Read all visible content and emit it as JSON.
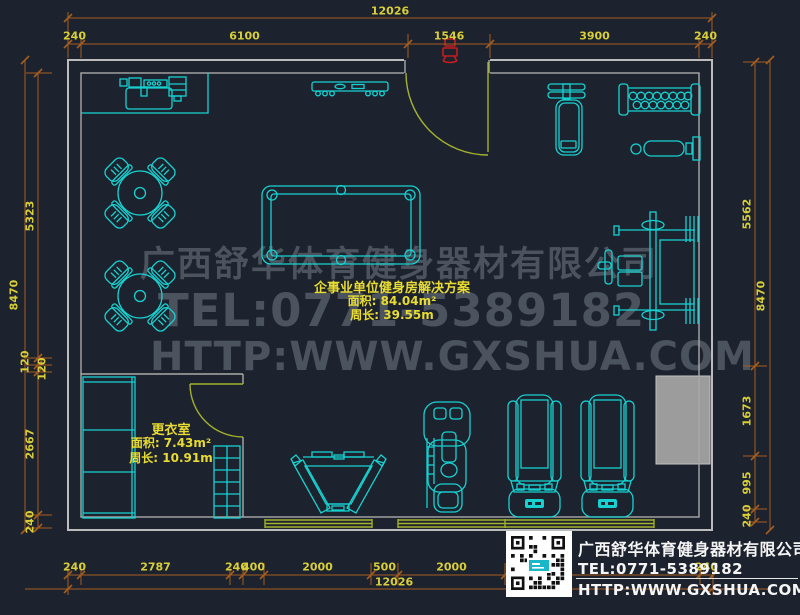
{
  "plan": {
    "room_label": {
      "title": "企事业单位健身房解决方案",
      "area": "面积: 84.04m²",
      "perimeter": "周长: 39.55m"
    },
    "changing_room_label": {
      "title": "更衣室",
      "area": "面积: 7.43m²",
      "perimeter": "周长: 10.91m"
    }
  },
  "watermark": {
    "company": "广西舒华体育健身器材有限公司",
    "tel": "TEL:0771-5389182",
    "website": "HTTP:WWW.GXSHUA.COM"
  },
  "footer": {
    "company": "广西舒华体育健身器材有限公司",
    "tel": "TEL:0771-5389182",
    "website": "HTTP:WWW.GXSHUA.COM"
  },
  "dimensions": {
    "top": {
      "overall": "12026",
      "chain": [
        "240",
        "6100",
        "1546",
        "3900",
        "240"
      ]
    },
    "bottom": {
      "overall": "12026",
      "chain": [
        "240",
        "2787",
        "240",
        "400",
        "2000",
        "500",
        "2000",
        "",
        "240"
      ]
    },
    "left": {
      "overall": "8470",
      "chain": [
        "5323",
        "120",
        "120",
        "2667",
        "240"
      ]
    },
    "right": {
      "overall": "8470",
      "chain": [
        "5562",
        "1673",
        "995",
        "240"
      ]
    }
  },
  "colors": {
    "background": "#1d232e",
    "wall": "#a9a9a9",
    "equipment": "#17d1d1",
    "dimension_line": "#a55e20",
    "dimension_text": "#d8ce38",
    "door": "#a3b12e",
    "label_text": "#e8dc32",
    "watermark": "rgba(158,168,180,0.36)",
    "footer_text": "#f5f5f5",
    "highlight_red": "#c41e1e",
    "column_fill": "#9c9c9c"
  }
}
